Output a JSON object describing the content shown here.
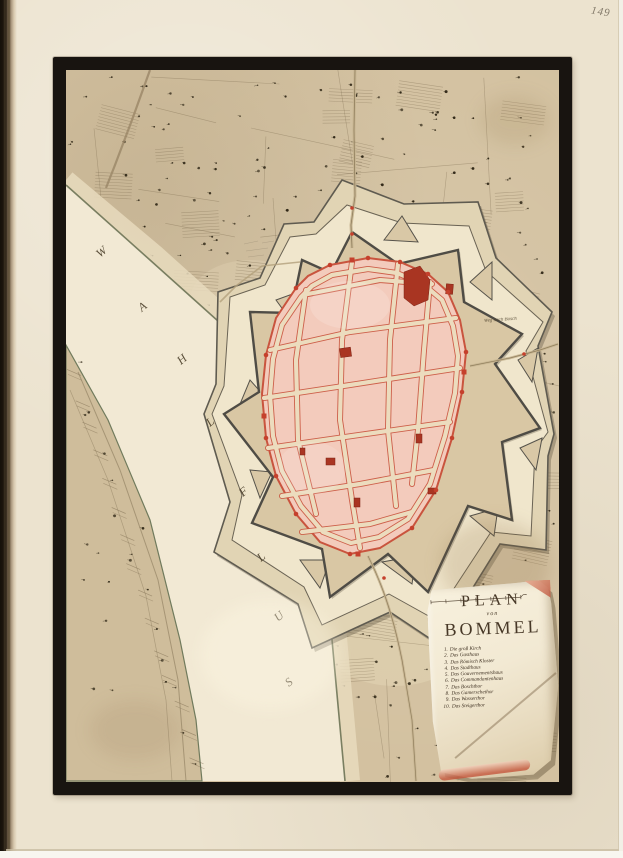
{
  "page": {
    "number": "149"
  },
  "map": {
    "river": {
      "name": "Wahl Flus",
      "letters": [
        "W",
        "A",
        "H",
        "L",
        "F",
        "L",
        "U",
        "S"
      ]
    },
    "road_label": "Weg nach Bosch",
    "cartouche": {
      "title": "PLAN",
      "subtitle": "von",
      "title2": "BOMMEL",
      "legend": [
        {
          "num": "1.",
          "label": "Die groß Kirch"
        },
        {
          "num": "2.",
          "label": "Das Gasthaus"
        },
        {
          "num": "3.",
          "label": "Das Römisch Kloster"
        },
        {
          "num": "4.",
          "label": "Das Stadthaus"
        },
        {
          "num": "5.",
          "label": "Das Gouvernementshaus"
        },
        {
          "num": "6.",
          "label": "Das Commandantenhaus"
        },
        {
          "num": "7.",
          "label": "Das Boschthor"
        },
        {
          "num": "8.",
          "label": "Das Gamerschethor"
        },
        {
          "num": "9.",
          "label": "Das Wasserthor"
        },
        {
          "num": "10.",
          "label": "Das Steigerthor"
        }
      ]
    }
  },
  "colors": {
    "paper": "#ece3cf",
    "frame": "#181410",
    "land": "#d3c1a0",
    "river": "#f2e9d4",
    "town_pink": "#f3cbbc",
    "accent_red": "#c9543e",
    "building_red": "#b03226",
    "ink": "#43351f"
  }
}
